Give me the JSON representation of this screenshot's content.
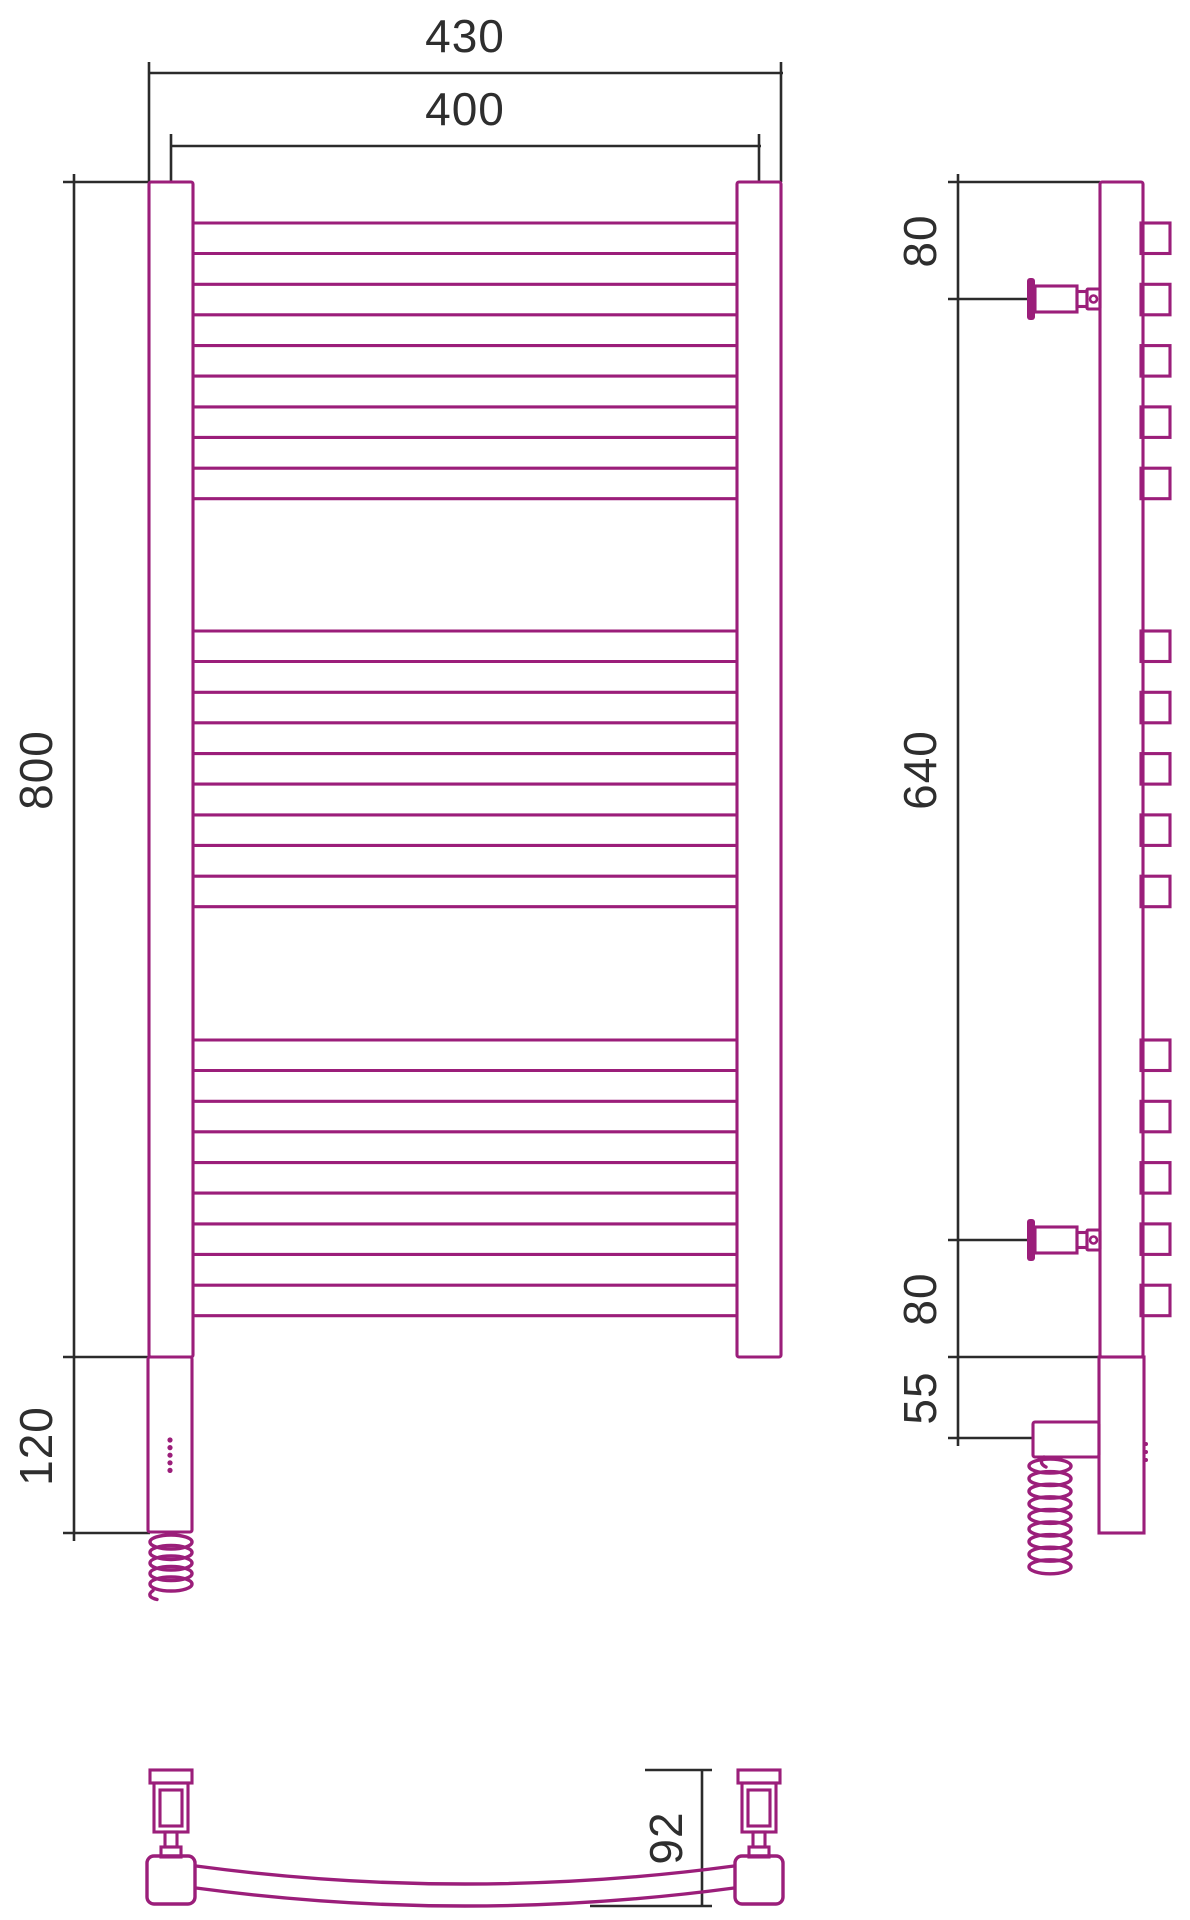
{
  "drawing_type": "towel-rail-technical-drawing",
  "labels": {
    "width_overall": "430",
    "width_pipes": "400",
    "height_rail": "800",
    "height_unit": "120",
    "offset_top": "80",
    "bracket_span": "640",
    "offset_bottom": "80",
    "unit_offset": "55",
    "depth": "92"
  },
  "colors": {
    "product_line": "#9b1e7a",
    "dimension_line": "#2b2b2b"
  },
  "geometry": {
    "front": {
      "postLeftX": 149,
      "postRightX": 737,
      "postW": 44,
      "top": 182,
      "bottom": 1357,
      "tubeX1": 193,
      "tubeX2": 737,
      "tubeH": 30.5,
      "tubePitch": 61.3,
      "groupStarts": [
        223,
        631,
        1040
      ],
      "tubesPerGroup": 5,
      "unit": {
        "x": 148,
        "w": 44,
        "y1": 1357,
        "y2": 1532
      },
      "leds": {
        "cx": 170,
        "y0": 1440,
        "dy": 7.6,
        "n": 5,
        "r": 2.6
      },
      "coil": {
        "cx": 171,
        "y0": 1542,
        "dy": 10.5,
        "n": 5,
        "rx": 21,
        "ry": 7
      }
    },
    "side": {
      "postX": 1100,
      "postW": 43,
      "top": 182,
      "bottom": 1357,
      "stubX1": 1141,
      "stubW": 29,
      "unit": {
        "x": 1099,
        "w": 45,
        "y1": 1357,
        "y2": 1533
      },
      "box": {
        "x": 1033,
        "y": 1422,
        "w": 66,
        "h": 35
      },
      "bracketCenters": [
        299,
        1240
      ],
      "coil": {
        "cx": 1050,
        "y0": 1466,
        "dy": 12.6,
        "n": 9,
        "rx": 21,
        "ry": 7
      },
      "sideLeds": {
        "cx": 1146,
        "y0": 1444,
        "dy": 8,
        "n": 3,
        "r": 2
      }
    },
    "bottom": {
      "blocks": [
        147,
        735
      ],
      "blockY": 1856,
      "blockSize": 48,
      "bracketCenters": [
        171,
        759
      ],
      "bracket": {
        "capHw": 21,
        "capY1": 1770,
        "capY2": 1783,
        "outerHw": 17,
        "outerY2": 1832,
        "innerHw": 11,
        "innerY1": 1790,
        "innerY2": 1826,
        "neckHw": 6,
        "neckY2": 1847,
        "footHw": 10,
        "footY2": 1857
      },
      "arcTop": {
        "x1": 196,
        "y1": 1866,
        "cx": 465,
        "cy": 1902,
        "x2": 734,
        "y2": 1866
      },
      "arcBot": {
        "x1": 196,
        "y1": 1888,
        "cx": 465,
        "cy": 1924,
        "x2": 734,
        "y2": 1888
      }
    },
    "dims": {
      "front430": {
        "y": 73,
        "x1": 149,
        "x2": 783,
        "extY1": 62,
        "extY2": 182,
        "e1": 149,
        "e2": 781
      },
      "front400": {
        "y": 146,
        "x1": 171,
        "x2": 761,
        "extY1": 134,
        "extY2": 182,
        "e1": 171,
        "e2": 759
      },
      "frontLeft": {
        "x": 74,
        "y1": 174,
        "y2": 1541,
        "extX1": 63,
        "extX2": 150,
        "extYs": [
          182,
          1357,
          1533
        ]
      },
      "sideLeft": {
        "x": 958,
        "y1": 174,
        "y2": 1446,
        "extX1": 948,
        "exts": [
          {
            "y": 182,
            "x2": 1100
          },
          {
            "y": 299,
            "x2": 1028
          },
          {
            "y": 1240,
            "x2": 1028
          },
          {
            "y": 1357,
            "x2": 1143
          },
          {
            "y": 1438,
            "x2": 1033
          }
        ]
      },
      "dim92": {
        "x": 702,
        "y1": 1770,
        "y2": 1906,
        "extTop": {
          "y": 1770,
          "x1": 645,
          "x2": 712
        },
        "extBot": {
          "y": 1906,
          "x1": 590,
          "x2": 712
        }
      }
    }
  }
}
